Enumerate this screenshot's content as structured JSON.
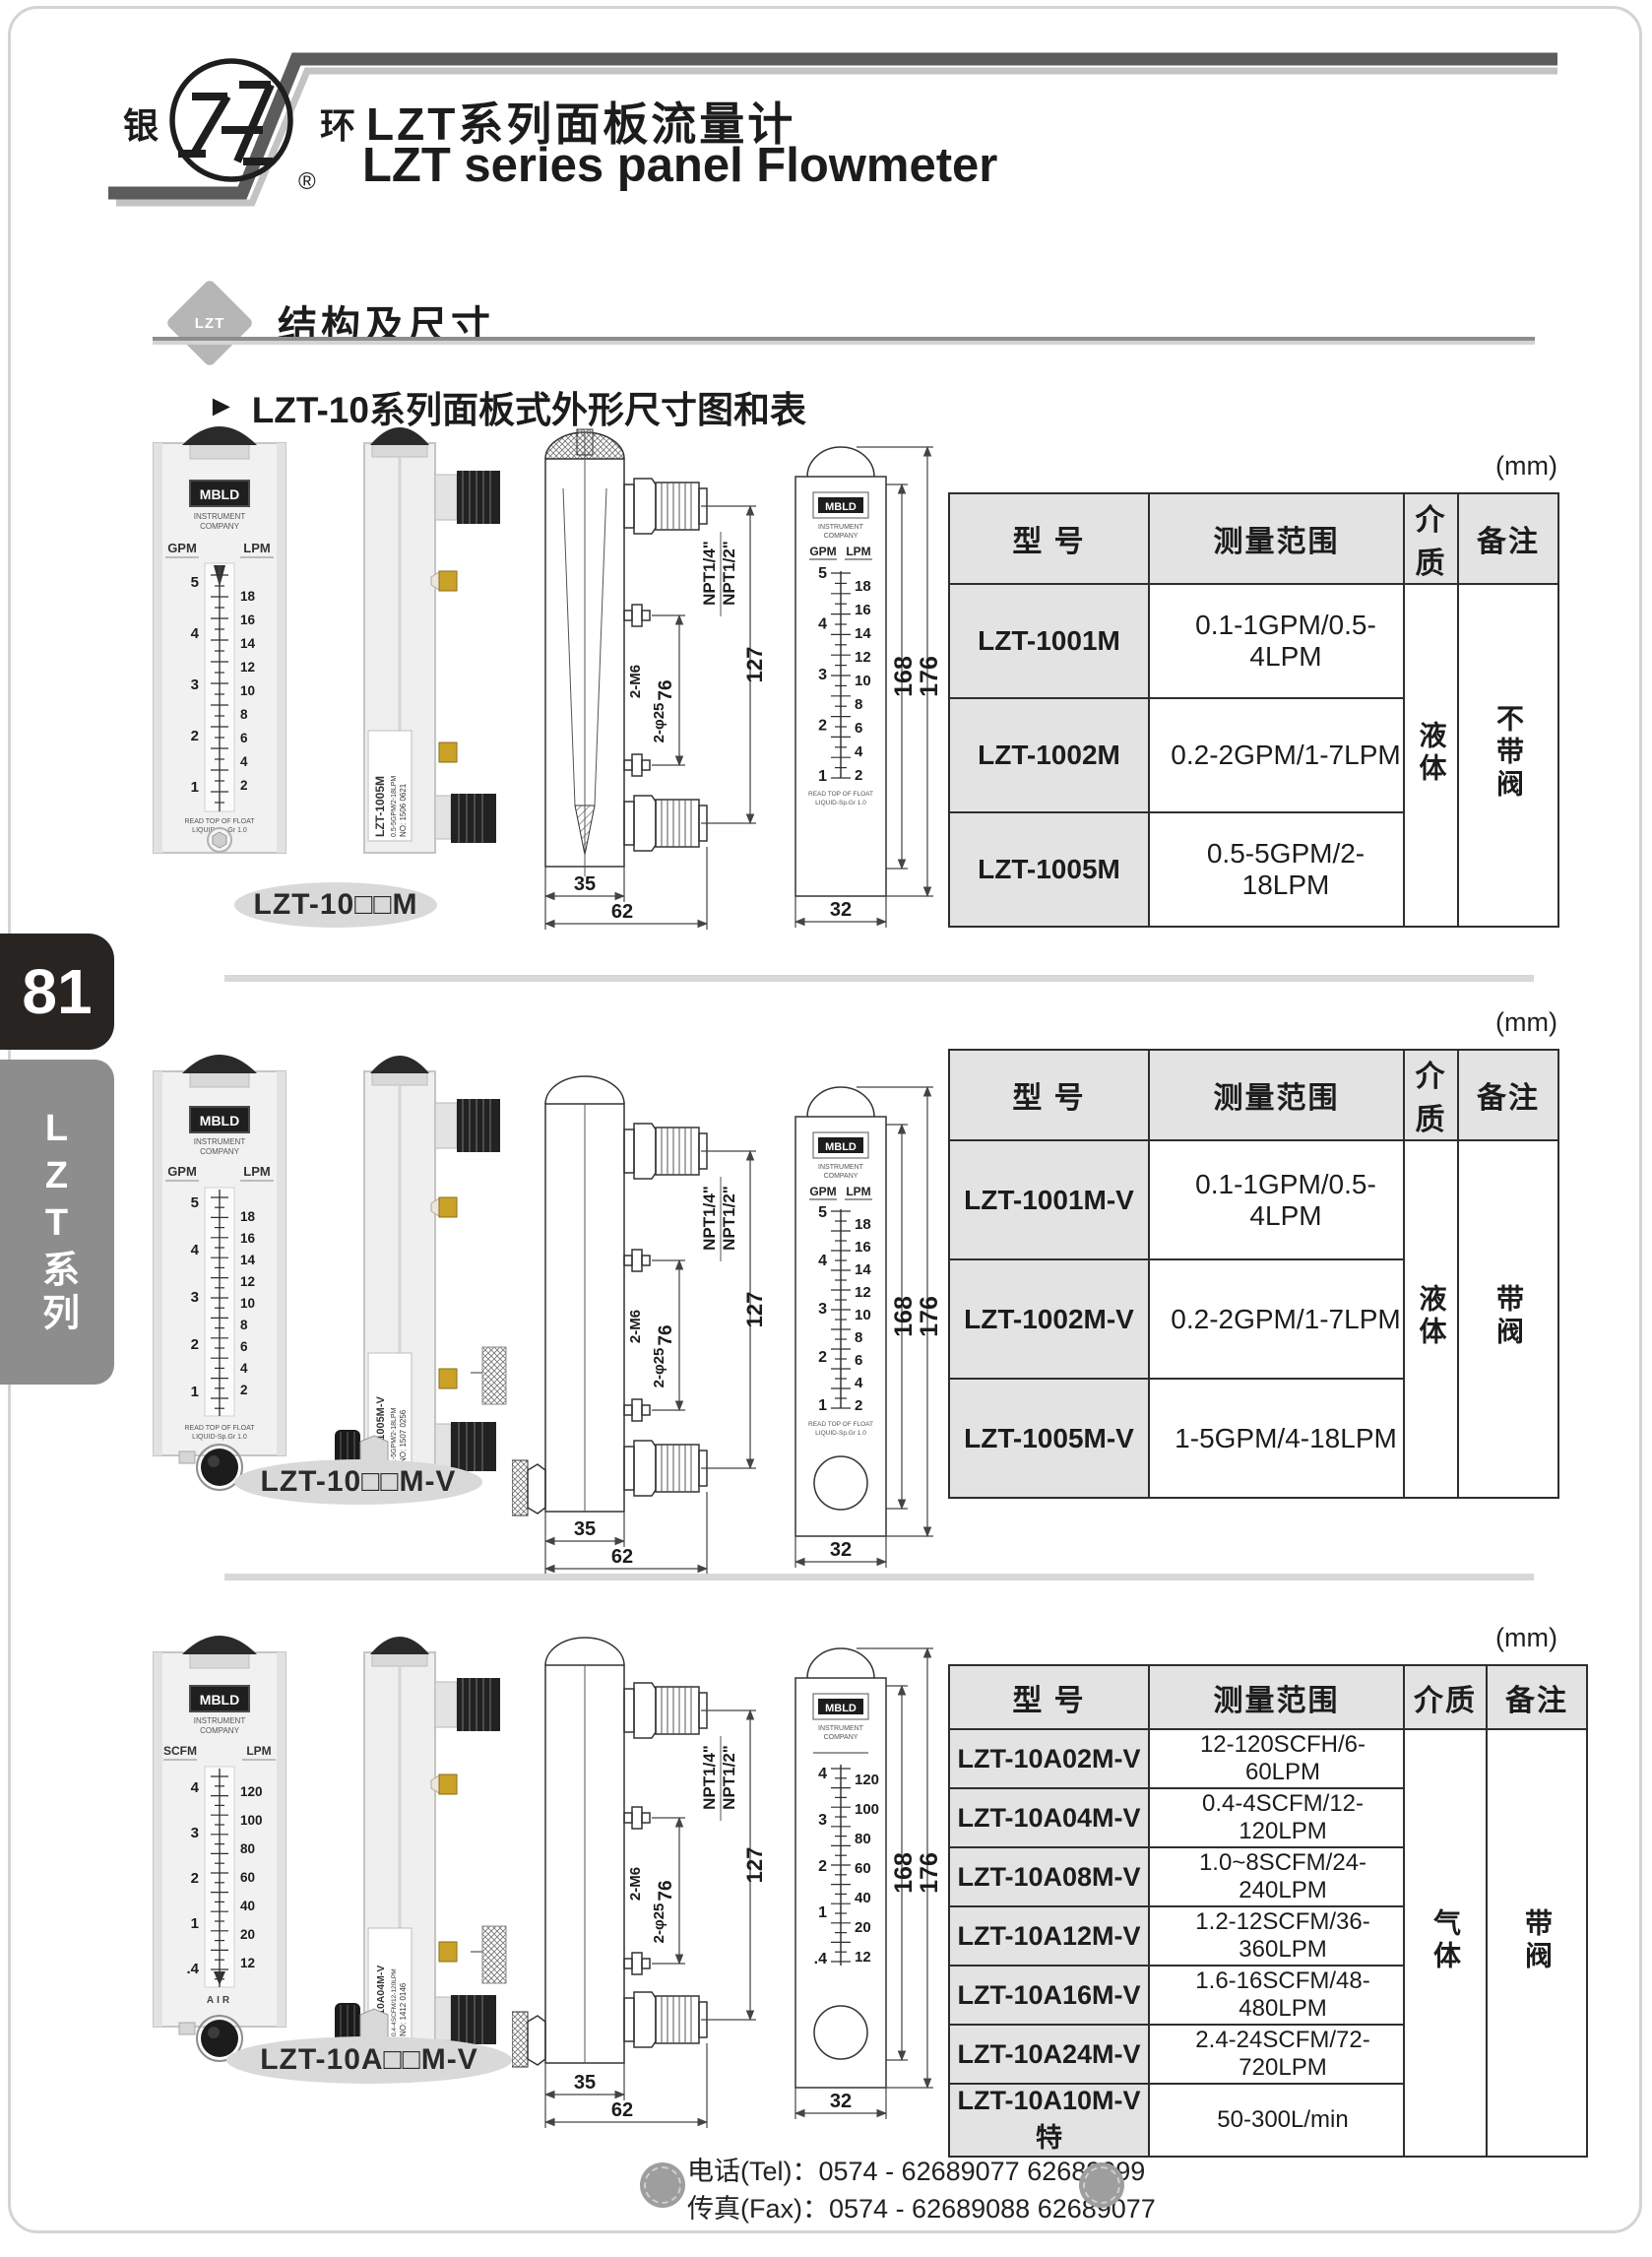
{
  "page": {
    "number": "81",
    "series_tab": "LZT系列",
    "unit_note": "(mm)"
  },
  "header": {
    "logo_left": "银",
    "logo_right": "环",
    "logo_reg": "®",
    "title_cn": "LZT系列面板流量计",
    "title_en": "LZT series panel Flowmeter"
  },
  "section": {
    "badge": "LZT",
    "heading": "结构及尺寸",
    "marker": "►",
    "subheading": "LZT-10系列面板式外形尺寸图和表"
  },
  "labels": {
    "row1": "LZT-10□□M",
    "row2": "LZT-10□□M-V",
    "row3": "LZT-10A□□M-V"
  },
  "tables": {
    "headers": {
      "model": "型  号",
      "range": "测量范围",
      "medium": "介质",
      "remark": "备注"
    },
    "t1": {
      "rows": [
        [
          "LZT-1001M",
          "0.1-1GPM/0.5-4LPM"
        ],
        [
          "LZT-1002M",
          "0.2-2GPM/1-7LPM"
        ],
        [
          "LZT-1005M",
          "0.5-5GPM/2-18LPM"
        ]
      ],
      "medium": "液体",
      "remark": "不带阀"
    },
    "t2": {
      "rows": [
        [
          "LZT-1001M-V",
          "0.1-1GPM/0.5-4LPM"
        ],
        [
          "LZT-1002M-V",
          "0.2-2GPM/1-7LPM"
        ],
        [
          "LZT-1005M-V",
          "1-5GPM/4-18LPM"
        ]
      ],
      "medium": "液体",
      "remark": "带阀"
    },
    "t3": {
      "rows": [
        [
          "LZT-10A02M-V",
          "12-120SCFH/6-60LPM"
        ],
        [
          "LZT-10A04M-V",
          "0.4-4SCFM/12-120LPM"
        ],
        [
          "LZT-10A08M-V",
          "1.0~8SCFM/24-240LPM"
        ],
        [
          "LZT-10A12M-V",
          "1.2-12SCFM/36-360LPM"
        ],
        [
          "LZT-10A16M-V",
          "1.6-16SCFM/48-480LPM"
        ],
        [
          "LZT-10A24M-V",
          "2.4-24SCFM/72-720LPM"
        ],
        [
          "LZT-10A10M-V特",
          "50-300L/min"
        ]
      ],
      "medium": "气体",
      "remark": "带阀"
    }
  },
  "dims": {
    "w_body": "35",
    "w_total": "62",
    "npt_small": "NPT1/4\"",
    "npt_big": "NPT1/2\"",
    "bolt_span": "76",
    "port_span": "127",
    "bolt": "2-M6",
    "hole": "2-φ25",
    "h_body": "168",
    "h_total": "176",
    "w_front": "32"
  },
  "meter": {
    "brand": "MBLD",
    "brand_sub1": "INSTRUMENT",
    "brand_sub2": "COMPANY",
    "read1": "READ TOP OF FLOAT",
    "read2": "LIQUID-Sp.Gr 1.0",
    "liquid": {
      "unit_left": "GPM",
      "unit_right": "LPM",
      "scale_left": [
        "5",
        "4",
        "3",
        "2",
        "1"
      ],
      "scale_right": [
        "18",
        "16",
        "14",
        "12",
        "10",
        "8",
        "6",
        "4",
        "2"
      ]
    },
    "gas": {
      "unit_left": "SCFM",
      "unit_right": "LPM",
      "scale_left": [
        "4",
        "3",
        "2",
        "1",
        ".4"
      ],
      "scale_right": [
        "120",
        "100",
        "80",
        "60",
        "40",
        "20",
        "12"
      ],
      "air": "AIR"
    },
    "stickers": {
      "row1": [
        "LZT-1005M",
        "0.5-5GPM/2-18LPM",
        "NO: 1506  0621"
      ],
      "row2": [
        "LZT-1005M-V",
        "1-5GPM/2-18LPM",
        "NO: 1507  0256"
      ],
      "row3": [
        "LZT-10A04M-V",
        "0.4-4SCFM/12-120LPM",
        "NO: 1412  0146"
      ]
    }
  },
  "footer": {
    "tel_label": "电话(Tel)：",
    "tel": "0574 - 62689077  62689099",
    "fax_label": "传真(Fax)：",
    "fax": "0574 - 62689088  62689077"
  }
}
